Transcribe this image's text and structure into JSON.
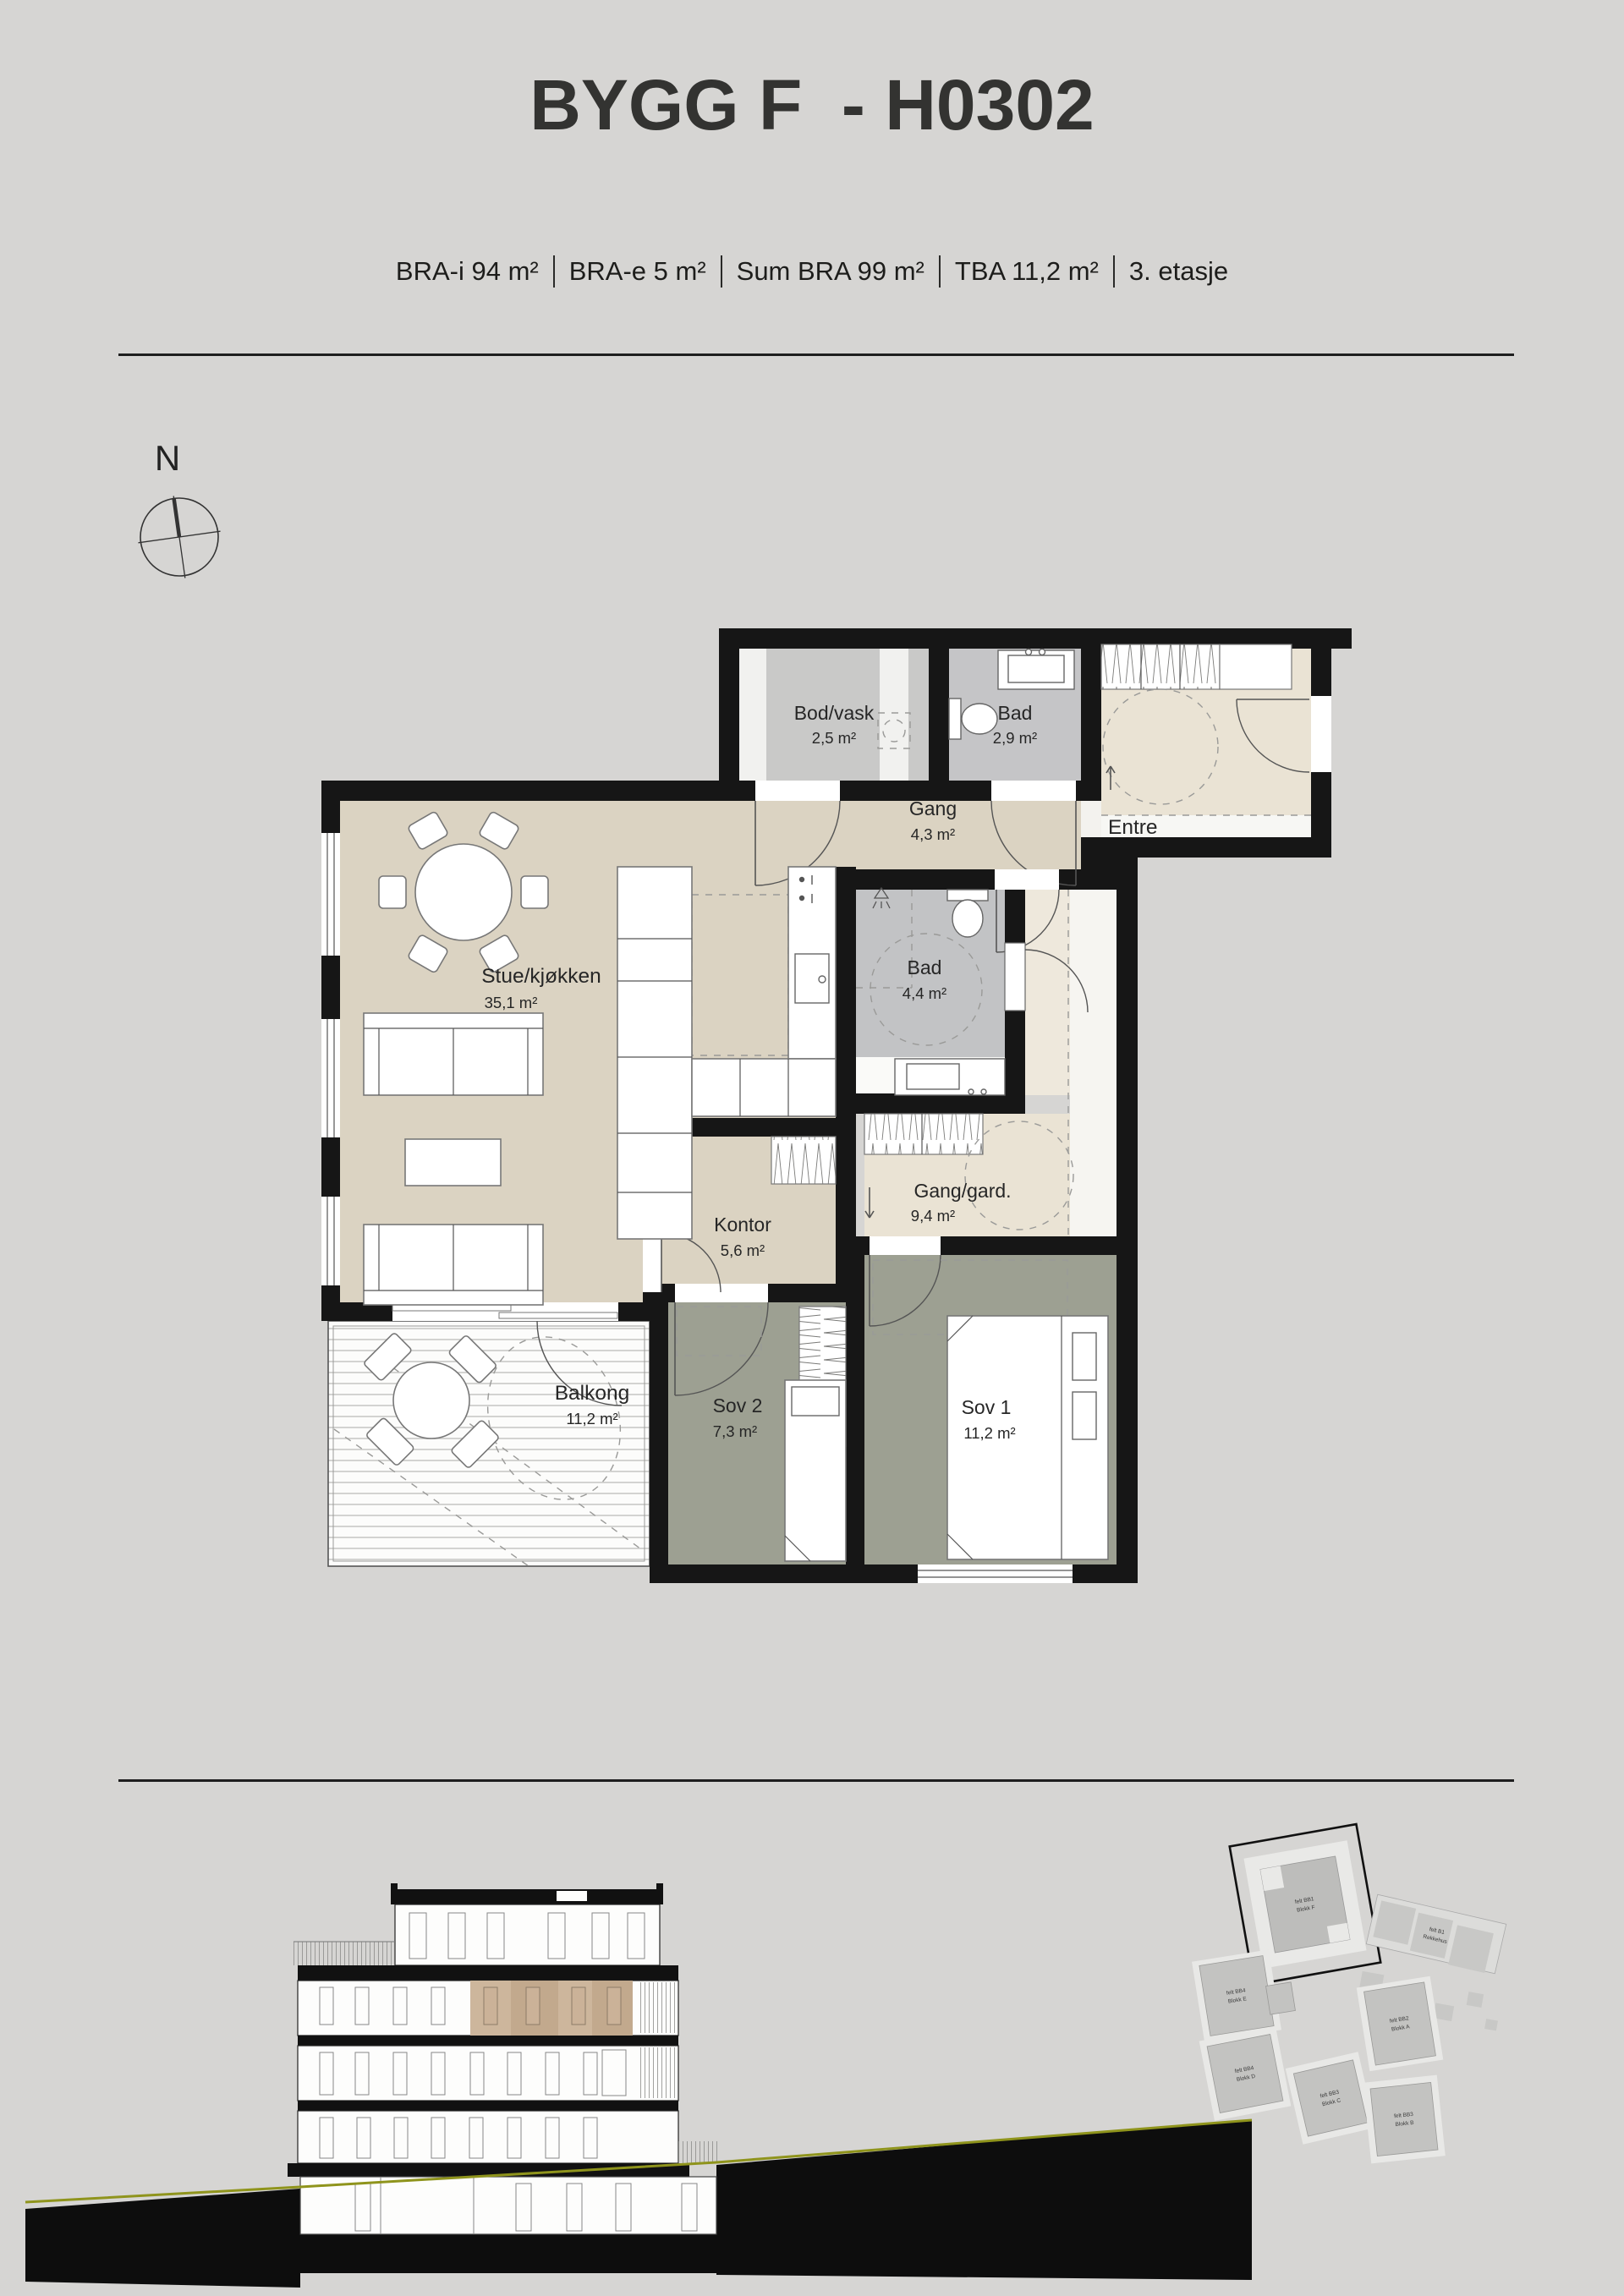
{
  "header": {
    "title": "BYGG F  - H0302",
    "stats": [
      "BRA-i 94 m²",
      "BRA-e 5 m²",
      "Sum BRA 99 m²",
      "TBA 11,2 m²",
      "3. etasje"
    ]
  },
  "compass": {
    "north_label": "N"
  },
  "floorplan": {
    "rooms": {
      "bod_vask": {
        "name": "Bod/vask",
        "area": "2,5 m²"
      },
      "bad_small": {
        "name": "Bad",
        "area": "2,9 m²"
      },
      "entre": {
        "name": "Entre"
      },
      "gang": {
        "name": "Gang",
        "area": "4,3 m²"
      },
      "stue_kjokken": {
        "name": "Stue/kjøkken",
        "area": "35,1 m²"
      },
      "bad_large": {
        "name": "Bad",
        "area": "4,4 m²"
      },
      "kontor": {
        "name": "Kontor",
        "area": "5,6 m²"
      },
      "gang_gard": {
        "name": "Gang/gard.",
        "area": "9,4 m²"
      },
      "balkong": {
        "name": "Balkong",
        "area": "11,2 m²"
      },
      "sov1": {
        "name": "Sov 1",
        "area": "11,2 m²"
      },
      "sov2": {
        "name": "Sov 2",
        "area": "7,3 m²"
      }
    }
  },
  "site_plan": {
    "blocks": [
      {
        "felt": "felt BB1",
        "name": "Blokk F"
      },
      {
        "felt": "felt B1",
        "name": "Rekkehus"
      },
      {
        "felt": "felt BB4",
        "name": "Blokk E"
      },
      {
        "felt": "felt BB2",
        "name": "Blokk A"
      },
      {
        "felt": "felt BB4",
        "name": "Blokk D"
      },
      {
        "felt": "felt BB3",
        "name": "Blokk C"
      },
      {
        "felt": "felt BB3",
        "name": "Blokk B"
      }
    ]
  },
  "colors": {
    "background": "#d6d5d3",
    "wall": "#161616",
    "floor_main": "#dbd3c2",
    "floor_light": "#eae3d4",
    "floor_bath": "#c5c5c7",
    "floor_bedroom": "#9da092",
    "section_highlight": "#cdb69c",
    "terrain_line": "#8f941c"
  }
}
